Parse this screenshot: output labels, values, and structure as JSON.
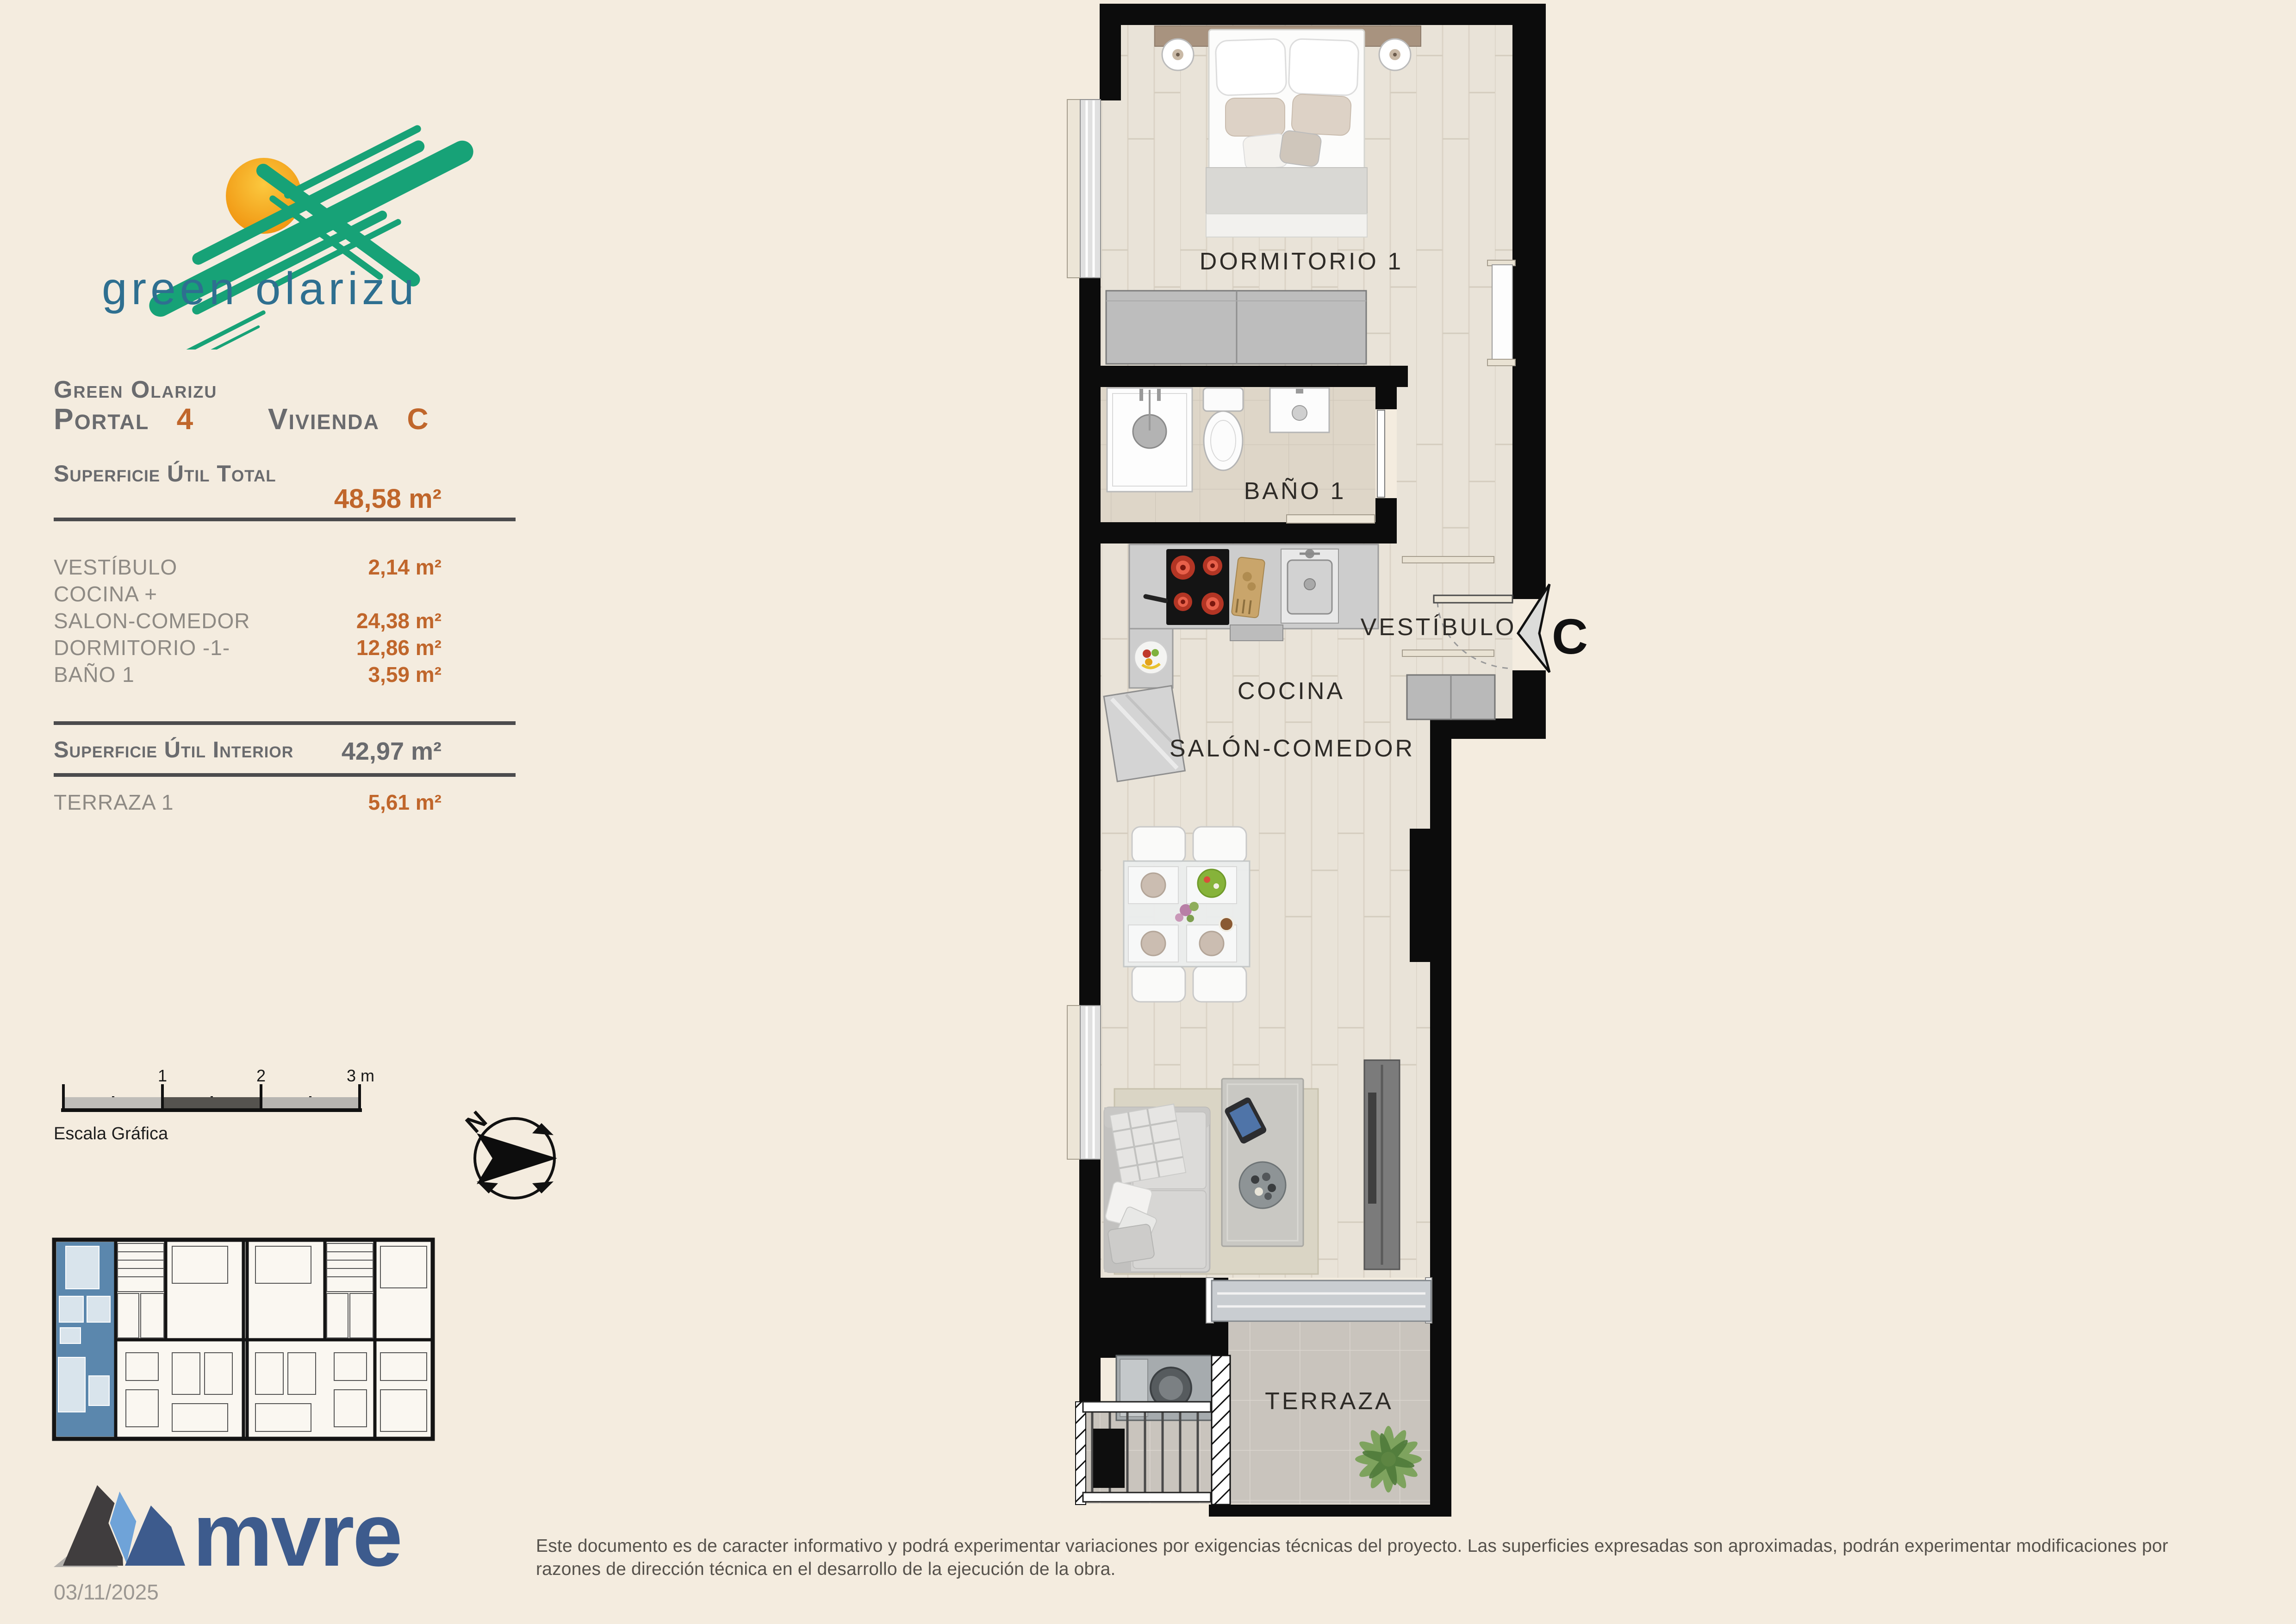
{
  "page": {
    "background": "#f4ecdf"
  },
  "brand": {
    "logo_text": "green olarizu"
  },
  "title": {
    "project": "Green Olarizu",
    "portal_label": "Portal",
    "portal_number": "4",
    "vivienda_label": "Vivienda",
    "vivienda_letter": "C"
  },
  "surfaces": {
    "total_label": "Superficie Útil Total",
    "total_value": "48,58 m²",
    "rows": [
      {
        "label": "VESTÍBULO",
        "value": "2,14 m²"
      },
      {
        "label": "COCINA +",
        "value": ""
      },
      {
        "label": "SALON-COMEDOR",
        "value": "24,38 m²"
      },
      {
        "label": "DORMITORIO -1-",
        "value": "12,86 m²"
      },
      {
        "label": "BAÑO 1",
        "value": "3,59 m²"
      }
    ],
    "interior_label": "Superficie Útil Interior",
    "interior_value": "42,97 m²",
    "terrace_label": "TERRAZA 1",
    "terrace_value": "5,61 m²"
  },
  "scalebar": {
    "label": "Escala Gráfica",
    "t1": "1",
    "t2": "2",
    "t3": "3 m."
  },
  "compass": {
    "north": "N"
  },
  "plan": {
    "rooms": {
      "bedroom": "DORMITORIO 1",
      "bath": "BAÑO 1",
      "hall": "VESTÍBULO",
      "kitchen": "COCINA",
      "living": "SALÓN-COMEDOR",
      "terrace": "TERRAZA"
    },
    "unit_letter": "C"
  },
  "footer": {
    "brand": "mvre",
    "date": "03/11/2025",
    "disclaimer1": "Este documento es de caracter informativo y podrá experimentar variaciones por exigencias técnicas del proyecto. Las superficies expresadas son aproximadas, podrán experimentar modificaciones por",
    "disclaimer2": "razones de dirección técnica en el desarrollo de la ejecución de la obra."
  }
}
